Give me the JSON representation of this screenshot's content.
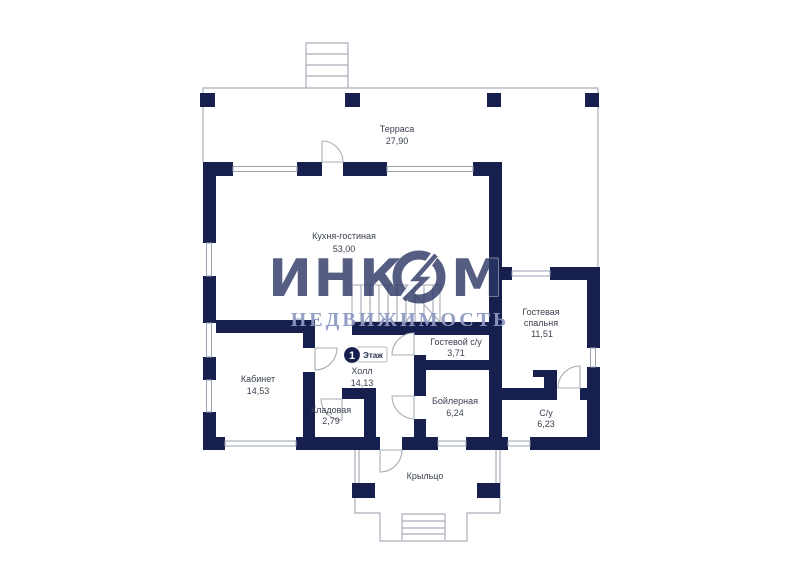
{
  "watermark": {
    "brand": "ИНКОМ",
    "brand_left": "ИНК",
    "brand_right": "М",
    "subtitle": "НЕДВИЖИМОСТЬ"
  },
  "floor_badge": {
    "number": "1",
    "label": "Этаж"
  },
  "rooms": {
    "terrace": {
      "name": "Терраса",
      "area": "27,90"
    },
    "kitchen_living": {
      "name": "Кухня-гостиная",
      "area": "53,00"
    },
    "guest_bedroom": {
      "name_line1": "Гостевая",
      "name_line2": "спальня",
      "area": "11,51"
    },
    "guest_wc": {
      "name": "Гостевой с/у",
      "area": "3,71"
    },
    "office": {
      "name": "Кабинет",
      "area": "14,53"
    },
    "hall": {
      "name": "Холл",
      "area": "14,13"
    },
    "storage": {
      "name": "Кладовая",
      "area": "2,79"
    },
    "boiler": {
      "name": "Бойлерная",
      "area": "6,24"
    },
    "wc": {
      "name": "С/у",
      "area": "6,23"
    },
    "porch": {
      "name": "Крыльцо"
    }
  },
  "colors": {
    "wall": "#161f4d",
    "thin_line": "#a9aeb9",
    "window_frame": "#9aa2b0",
    "label_text": "#3a4150",
    "watermark_brand": "#2b3764",
    "watermark_subtitle": "#8e9ac2",
    "background": "#ffffff"
  }
}
